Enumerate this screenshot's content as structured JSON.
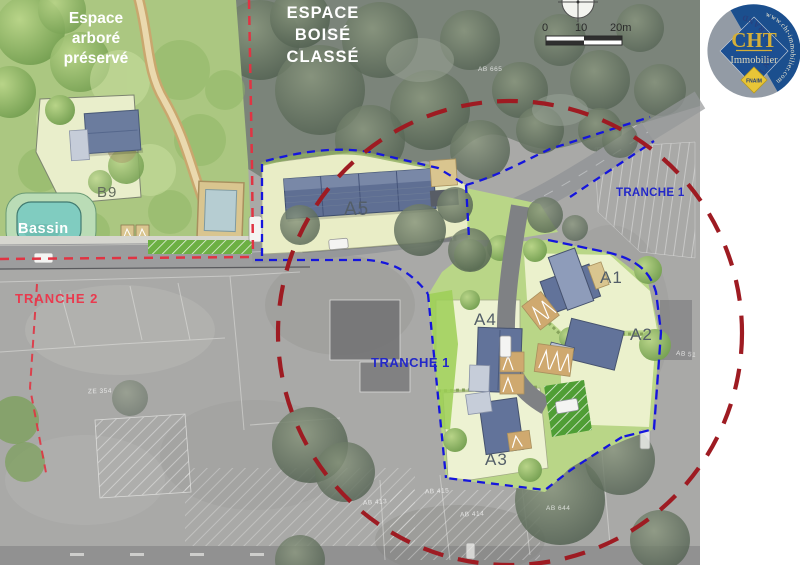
{
  "map": {
    "zones": {
      "espace_arbore": {
        "line1": "Espace",
        "line2": "arboré",
        "line3": "préservé"
      },
      "espace_boise": {
        "line1": "ESPACE",
        "line2": "BOISÉ",
        "line3": "CLASSÉ"
      },
      "tranche1_center": "TRANCHE 1",
      "tranche1_right": "TRANCHE 1",
      "tranche2": "TRANCHE 2",
      "bassin": "Bassin"
    },
    "lots": {
      "a1": "A1",
      "a2": "A2",
      "a3": "A3",
      "a4": "A4",
      "a5": "A5",
      "b9": "B9"
    },
    "parcels": {
      "p1": "AB 665",
      "p2": "ZE 354",
      "p3": "AB 413",
      "p4": "AB 414",
      "p5": "AB 415",
      "p6": "AB 644",
      "p7": "AB 51"
    },
    "scale_bar": {
      "tick0": "0",
      "tick10": "10",
      "tick20": "20m"
    }
  },
  "logo": {
    "brand": "CHT",
    "brand_sub": "Immobilier",
    "org": "FNAIM",
    "arc_left": "PLELAN LE GRAND",
    "arc_right": "www.cht-immobilier.com"
  },
  "colors": {
    "tranche1_blue": "#2328c8",
    "tranche2_red": "#e93a4e",
    "boundary_blue": "#1515dd",
    "circle_red": "#9e1b22",
    "plan_green": "#abc781",
    "lot_cream": "#edf2d2"
  }
}
